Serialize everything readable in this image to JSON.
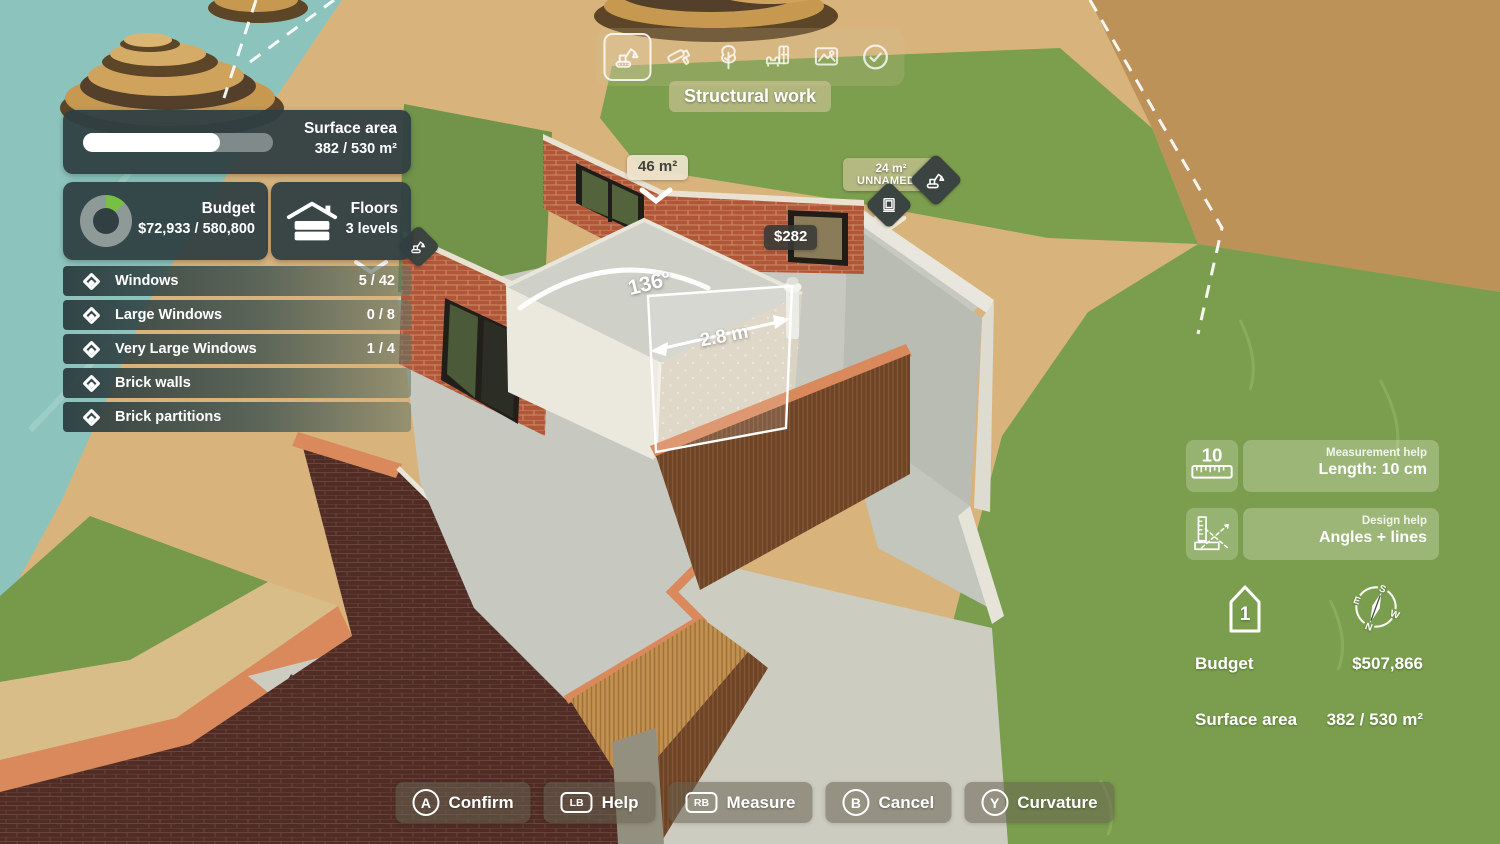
{
  "toolbar": {
    "label": "Structural work",
    "icons": [
      {
        "name": "excavator",
        "selected": true
      },
      {
        "name": "paint-roller",
        "selected": false
      },
      {
        "name": "tree",
        "selected": false
      },
      {
        "name": "furniture",
        "selected": false
      },
      {
        "name": "terrain",
        "selected": false
      },
      {
        "name": "confirm-check",
        "selected": false
      }
    ]
  },
  "stats": {
    "surface": {
      "title": "Surface area",
      "value": "382 / 530 m²",
      "progress_pct": 72
    },
    "budget": {
      "title": "Budget",
      "value": "$72,933 / 580,800",
      "spent_pct": 12.6
    },
    "floors": {
      "title": "Floors",
      "value": "3 levels"
    }
  },
  "objectives": [
    {
      "label": "Windows",
      "count": "5 / 42"
    },
    {
      "label": "Large Windows",
      "count": "0 / 8"
    },
    {
      "label": "Very Large Windows",
      "count": "1 / 4"
    },
    {
      "label": "Brick walls",
      "count": ""
    },
    {
      "label": "Brick partitions",
      "count": ""
    }
  ],
  "scene_labels": {
    "area_tag": "46 m²",
    "price_tag": "$282",
    "room_area": "24 m²",
    "room_name": "UNNAMED 4",
    "angle": "136°",
    "length": "2.8 m"
  },
  "help_panels": [
    {
      "category": "Measurement help",
      "label": "Length: 10 cm",
      "icon": "ruler-icon",
      "ruler_number": "10"
    },
    {
      "category": "Design help",
      "label": "Angles + lines",
      "icon": "angle-ruler-icon"
    }
  ],
  "info": {
    "floor_number": "1",
    "compass": {
      "n": "N",
      "s": "S",
      "e": "E",
      "w": "W"
    },
    "budget_label": "Budget",
    "budget_value": "$507,866",
    "surface_label": "Surface area",
    "surface_value": "382 / 530 m²"
  },
  "controls": [
    {
      "key": "A",
      "label": "Confirm",
      "key_shape": "circle"
    },
    {
      "key": "LB",
      "label": "Help",
      "key_shape": "rect"
    },
    {
      "key": "RB",
      "label": "Measure",
      "key_shape": "rect"
    },
    {
      "key": "B",
      "label": "Cancel",
      "key_shape": "circle"
    },
    {
      "key": "Y",
      "label": "Curvature",
      "key_shape": "circle"
    }
  ],
  "colors": {
    "panel_dark": "#2f3f42",
    "accent_green": "#76c043",
    "donut_track": "#8e9a98",
    "tag_dark": "#3c4441",
    "tag_light": "#eee4ce",
    "curb_orange": "#d9895c"
  }
}
